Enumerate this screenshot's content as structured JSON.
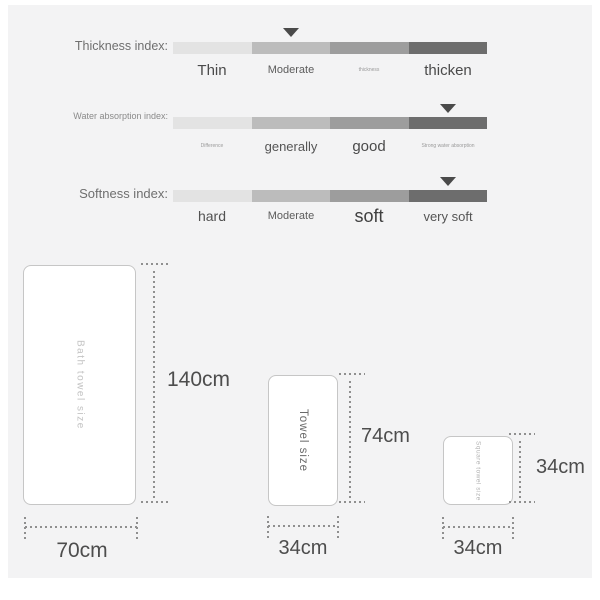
{
  "panel": {
    "background_color": "#f3f3f4",
    "bar_segment_colors": [
      "#e3e3e3",
      "#bcbcbc",
      "#9d9d9d",
      "#6d6d6d"
    ],
    "marker_color": "#4a4a4a"
  },
  "indexes": {
    "rows": [
      {
        "label": "Thickness index:",
        "marker_segment": 2,
        "scale": [
          "Thin",
          "Moderate",
          "thickness",
          "thicken"
        ]
      },
      {
        "label": "Water absorption index:",
        "marker_segment": 4,
        "scale": [
          "Difference",
          "generally",
          "good",
          "Strong water absorption"
        ]
      },
      {
        "label": "Softness index:",
        "marker_segment": 4,
        "scale": [
          "hard",
          "Moderate",
          "soft",
          "very soft"
        ]
      }
    ]
  },
  "towels": [
    {
      "name": "Bath towel size",
      "height_label": "140cm",
      "width_label": "70cm"
    },
    {
      "name": "Towel size",
      "height_label": "74cm",
      "width_label": "34cm"
    },
    {
      "name": "Square towel size",
      "height_label": "34cm",
      "width_label": "34cm"
    }
  ]
}
